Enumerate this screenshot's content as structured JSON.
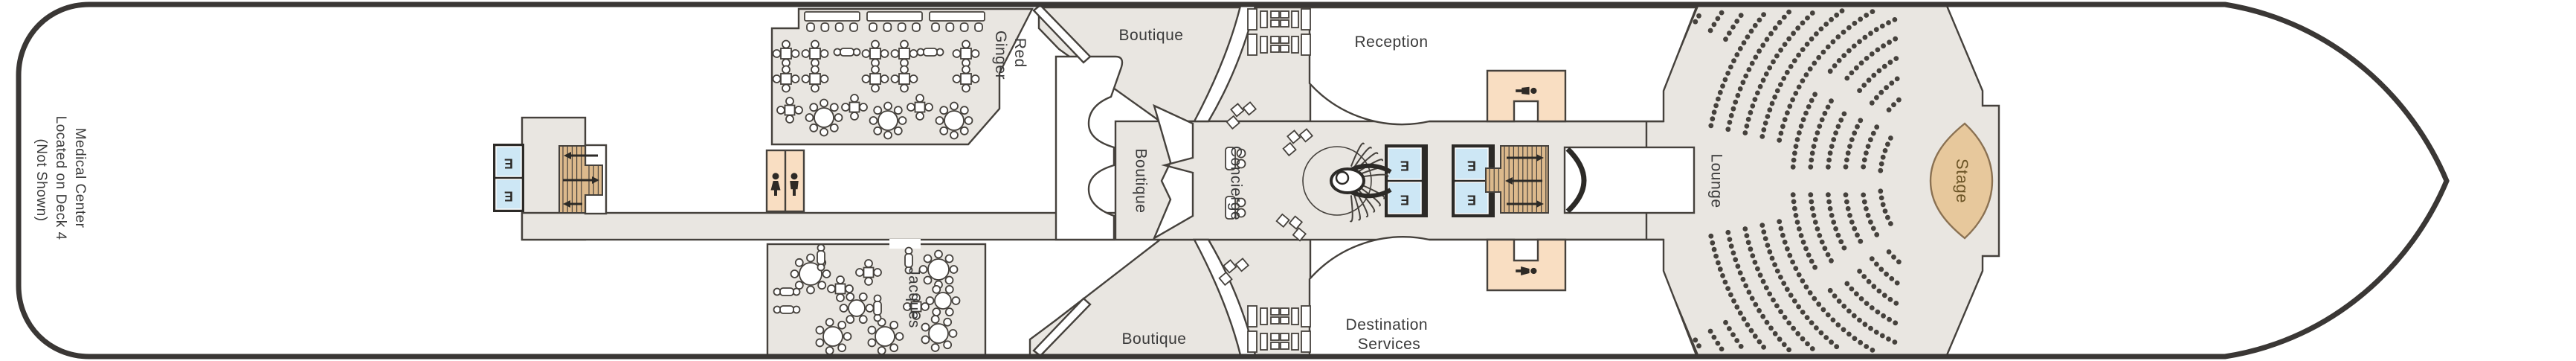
{
  "plan": {
    "title": "Ship deck plan",
    "labels": {
      "medical_1": "Medical Center",
      "medical_2": "Located on Deck 4",
      "medical_3": "(Not Shown)",
      "red_ginger_1": "Red",
      "red_ginger_2": "Ginger",
      "boutique_top": "Boutique",
      "boutique_center": "Boutique",
      "boutique_bottom": "Boutique",
      "reception": "Reception",
      "concierge": "Concierge",
      "jacques": "Jacques",
      "destination_1": "Destination",
      "destination_2": "Services",
      "lounge": "Lounge",
      "stage": "Stage",
      "elevator": "E"
    },
    "icons": {
      "elevator": "E-in-blue-box",
      "restroom_left": "woman-silhouette",
      "restroom_right": "man-silhouette",
      "crew_room_top": "person-silhouette",
      "crew_room_bottom": "person-silhouette",
      "stair_direction": "arrow"
    },
    "colors": {
      "hull": "#3a3735",
      "outline": "#45413c",
      "room_fill": "#e9e6e1",
      "white": "#ffffff",
      "peach": "#f9dec2",
      "elevator_blue": "#cde7f5",
      "elevator_frame": "#2c2a27",
      "stair_tan": "#dcb98c",
      "stage_fill": "#e7c89c",
      "stage_stroke": "#8a7152",
      "stage_label": "#6b5426",
      "label": "#3a3a3a",
      "seat": "#45413c",
      "icon": "#2e2a26"
    }
  }
}
